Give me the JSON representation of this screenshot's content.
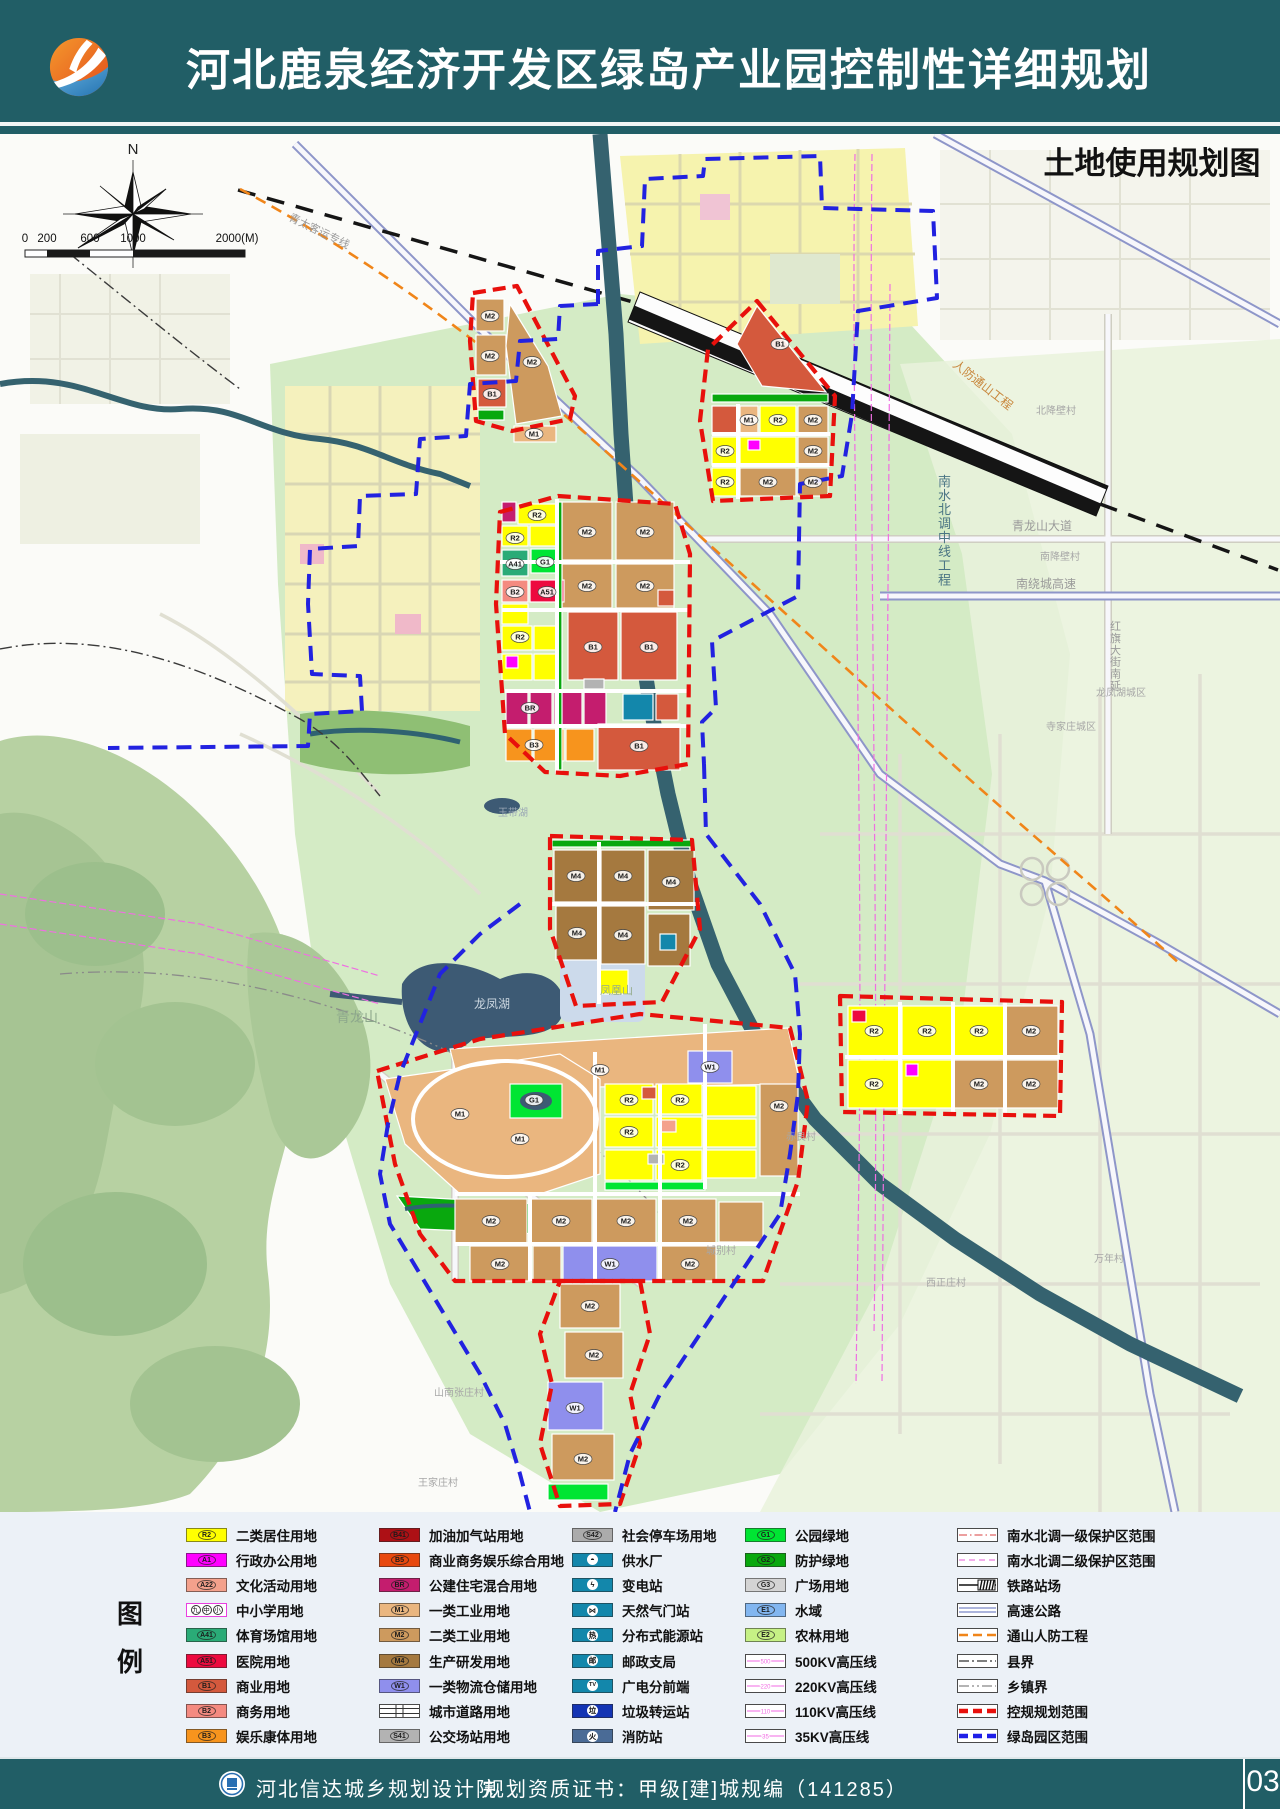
{
  "header": {
    "title": "河北鹿泉经济开发区绿岛产业园控制性详细规划",
    "accent_teal": "#215e66",
    "logo_orange": "#ec6a1e",
    "logo_blue": "#2f86c2"
  },
  "map": {
    "title": "土地使用规划图",
    "compass_label": "N",
    "scale": {
      "labels": [
        "0",
        "200",
        "600",
        "1000",
        "2000(M)"
      ]
    },
    "boundary_colors": {
      "regulatory": "#E8100C",
      "green_island": "#2222E0"
    },
    "place_labels": [
      {
        "text": "南水北调中线工程",
        "x": 938,
        "y": 352,
        "size": 13,
        "color": "#4b7584",
        "vertical": true
      },
      {
        "text": "人防通山工程",
        "x": 952,
        "y": 232,
        "size": 12,
        "color": "#c8863a",
        "rotate": 38
      },
      {
        "text": "青太客运专线",
        "x": 288,
        "y": 86,
        "size": 11,
        "color": "#9a9a9a",
        "rotate": 26
      },
      {
        "text": "青龙山大道",
        "x": 1012,
        "y": 396,
        "size": 12,
        "color": "#9a9a9a"
      },
      {
        "text": "南绕城高速",
        "x": 1016,
        "y": 454,
        "size": 12,
        "color": "#9a9a9a"
      },
      {
        "text": "红旗大街南延",
        "x": 1110,
        "y": 496,
        "size": 11,
        "color": "#9a9a9a",
        "vertical": true
      },
      {
        "text": "青龙山",
        "x": 336,
        "y": 888,
        "size": 14,
        "color": "#8da88c"
      },
      {
        "text": "龙凤湖",
        "x": 474,
        "y": 874,
        "size": 12,
        "color": "#cdd8e2"
      },
      {
        "text": "凤凰山",
        "x": 600,
        "y": 860,
        "size": 11,
        "color": "#94ab8a"
      },
      {
        "text": "玉带湖",
        "x": 498,
        "y": 682,
        "size": 10,
        "color": "#9aa7b5"
      },
      {
        "text": "北降壁村",
        "x": 1036,
        "y": 280,
        "size": 10,
        "color": "#a7a7a7"
      },
      {
        "text": "南降壁村",
        "x": 1040,
        "y": 426,
        "size": 10,
        "color": "#a7a7a7"
      },
      {
        "text": "龙凤湖城区",
        "x": 1096,
        "y": 562,
        "size": 10,
        "color": "#a7a7a7"
      },
      {
        "text": "寺家庄城区",
        "x": 1046,
        "y": 596,
        "size": 10,
        "color": "#a7a7a7"
      },
      {
        "text": "赤良村",
        "x": 786,
        "y": 1006,
        "size": 10,
        "color": "#a7a7a7"
      },
      {
        "text": "万年村",
        "x": 1094,
        "y": 1128,
        "size": 10,
        "color": "#a7a7a7"
      },
      {
        "text": "西正庄村",
        "x": 926,
        "y": 1152,
        "size": 10,
        "color": "#a7a7a7"
      },
      {
        "text": "城别村",
        "x": 706,
        "y": 1120,
        "size": 10,
        "color": "#a7a7a7"
      },
      {
        "text": "山南张庄村",
        "x": 434,
        "y": 1262,
        "size": 10,
        "color": "#a7a7a7"
      },
      {
        "text": "王家庄村",
        "x": 418,
        "y": 1352,
        "size": 10,
        "color": "#a7a7a7"
      }
    ],
    "parcel_codes": [
      {
        "code": "M2",
        "x": 490,
        "y": 182
      },
      {
        "code": "M2",
        "x": 490,
        "y": 222
      },
      {
        "code": "B1",
        "x": 492,
        "y": 260
      },
      {
        "code": "M2",
        "x": 532,
        "y": 228
      },
      {
        "code": "M1",
        "x": 534,
        "y": 300
      },
      {
        "code": "B1",
        "x": 780,
        "y": 210
      },
      {
        "code": "M1",
        "x": 749,
        "y": 286
      },
      {
        "code": "R2",
        "x": 778,
        "y": 286
      },
      {
        "code": "M2",
        "x": 813,
        "y": 286
      },
      {
        "code": "R2",
        "x": 725,
        "y": 317
      },
      {
        "code": "M2",
        "x": 813,
        "y": 317
      },
      {
        "code": "M2",
        "x": 768,
        "y": 348
      },
      {
        "code": "M2",
        "x": 813,
        "y": 348
      },
      {
        "code": "R2",
        "x": 725,
        "y": 348
      },
      {
        "code": "M2",
        "x": 587,
        "y": 398
      },
      {
        "code": "M2",
        "x": 645,
        "y": 398
      },
      {
        "code": "M2",
        "x": 587,
        "y": 452
      },
      {
        "code": "M2",
        "x": 645,
        "y": 452
      },
      {
        "code": "R2",
        "x": 537,
        "y": 381
      },
      {
        "code": "R2",
        "x": 515,
        "y": 404
      },
      {
        "code": "A41",
        "x": 515,
        "y": 430
      },
      {
        "code": "G1",
        "x": 545,
        "y": 428
      },
      {
        "code": "B2",
        "x": 515,
        "y": 458
      },
      {
        "code": "A51",
        "x": 547,
        "y": 458
      },
      {
        "code": "B1",
        "x": 593,
        "y": 513
      },
      {
        "code": "B1",
        "x": 649,
        "y": 513
      },
      {
        "code": "R2",
        "x": 520,
        "y": 503
      },
      {
        "code": "BR",
        "x": 530,
        "y": 574
      },
      {
        "code": "B3",
        "x": 534,
        "y": 611
      },
      {
        "code": "B1",
        "x": 639,
        "y": 612
      },
      {
        "code": "M4",
        "x": 576,
        "y": 742
      },
      {
        "code": "M4",
        "x": 623,
        "y": 742
      },
      {
        "code": "M4",
        "x": 671,
        "y": 748
      },
      {
        "code": "M4",
        "x": 577,
        "y": 799
      },
      {
        "code": "M4",
        "x": 623,
        "y": 801
      },
      {
        "code": "M1",
        "x": 600,
        "y": 936
      },
      {
        "code": "M1",
        "x": 460,
        "y": 980
      },
      {
        "code": "M1",
        "x": 520,
        "y": 1005
      },
      {
        "code": "G1",
        "x": 534,
        "y": 966
      },
      {
        "code": "R2",
        "x": 629,
        "y": 966
      },
      {
        "code": "R2",
        "x": 680,
        "y": 966
      },
      {
        "code": "R2",
        "x": 629,
        "y": 998
      },
      {
        "code": "R2",
        "x": 680,
        "y": 1031
      },
      {
        "code": "W1",
        "x": 710,
        "y": 933
      },
      {
        "code": "M2",
        "x": 779,
        "y": 972
      },
      {
        "code": "M2",
        "x": 491,
        "y": 1087
      },
      {
        "code": "M2",
        "x": 561,
        "y": 1087
      },
      {
        "code": "M2",
        "x": 626,
        "y": 1087
      },
      {
        "code": "M2",
        "x": 688,
        "y": 1087
      },
      {
        "code": "M2",
        "x": 500,
        "y": 1130
      },
      {
        "code": "W1",
        "x": 610,
        "y": 1130
      },
      {
        "code": "M2",
        "x": 690,
        "y": 1130
      },
      {
        "code": "R2",
        "x": 874,
        "y": 897
      },
      {
        "code": "R2",
        "x": 927,
        "y": 897
      },
      {
        "code": "R2",
        "x": 979,
        "y": 897
      },
      {
        "code": "M2",
        "x": 1031,
        "y": 897
      },
      {
        "code": "R2",
        "x": 874,
        "y": 950
      },
      {
        "code": "M2",
        "x": 979,
        "y": 950
      },
      {
        "code": "M2",
        "x": 1031,
        "y": 950
      },
      {
        "code": "M2",
        "x": 590,
        "y": 1172
      },
      {
        "code": "M2",
        "x": 594,
        "y": 1221
      },
      {
        "code": "W1",
        "x": 575,
        "y": 1274
      },
      {
        "code": "M2",
        "x": 583,
        "y": 1325
      }
    ]
  },
  "legend": {
    "panel_title": [
      "图",
      "例"
    ],
    "columns": [
      {
        "items": [
          {
            "label": "二类居住用地",
            "swatch": {
              "kind": "fill",
              "color": "#FFFF00",
              "code": "R2"
            }
          },
          {
            "label": "行政办公用地",
            "swatch": {
              "kind": "fill",
              "color": "#FF00FF",
              "code": "A1"
            }
          },
          {
            "label": "文化活动用地",
            "swatch": {
              "kind": "fill",
              "color": "#F4A18C",
              "code": "A22"
            }
          },
          {
            "label": "中小学用地",
            "swatch": {
              "kind": "school",
              "chars": [
                "九",
                "中",
                "小"
              ]
            }
          },
          {
            "label": "体育场馆用地",
            "swatch": {
              "kind": "fill",
              "color": "#2AAB77",
              "code": "A41"
            }
          },
          {
            "label": "医院用地",
            "swatch": {
              "kind": "fill",
              "color": "#ED0A3F",
              "code": "A51"
            }
          },
          {
            "label": "商业用地",
            "swatch": {
              "kind": "fill",
              "color": "#D4593D",
              "code": "B1"
            }
          },
          {
            "label": "商务用地",
            "swatch": {
              "kind": "fill",
              "color": "#F48A80",
              "code": "B2"
            }
          },
          {
            "label": "娱乐康体用地",
            "swatch": {
              "kind": "fill",
              "color": "#F7941D",
              "code": "B3"
            }
          }
        ]
      },
      {
        "items": [
          {
            "label": "加油加气站用地",
            "swatch": {
              "kind": "fill",
              "color": "#AD1015",
              "code": "B41"
            }
          },
          {
            "label": "商业商务娱乐综合用地",
            "swatch": {
              "kind": "fill",
              "color": "#E8490F",
              "code": "B5"
            }
          },
          {
            "label": "公建住宅混合用地",
            "swatch": {
              "kind": "fill",
              "color": "#C41D6E",
              "code": "BR"
            }
          },
          {
            "label": "一类工业用地",
            "swatch": {
              "kind": "fill",
              "color": "#EAB67F",
              "code": "M1"
            }
          },
          {
            "label": "二类工业用地",
            "swatch": {
              "kind": "fill",
              "color": "#CD9A5E",
              "code": "M2"
            }
          },
          {
            "label": "生产研发用地",
            "swatch": {
              "kind": "fill",
              "color": "#A5793F",
              "code": "M4"
            }
          },
          {
            "label": "一类物流仓储用地",
            "swatch": {
              "kind": "fill",
              "color": "#8F8FED",
              "code": "W1"
            }
          },
          {
            "label": "城市道路用地",
            "swatch": {
              "kind": "roadx"
            }
          },
          {
            "label": "公交场站用地",
            "swatch": {
              "kind": "fill",
              "color": "#B3B3B3",
              "code": "S41"
            }
          }
        ]
      },
      {
        "items": [
          {
            "label": "社会停车场用地",
            "swatch": {
              "kind": "fill",
              "color": "#ABABAB",
              "code": "S42"
            }
          },
          {
            "label": "供水厂",
            "swatch": {
              "kind": "icon",
              "bg": "#1387AB",
              "glyph": "◓"
            }
          },
          {
            "label": "变电站",
            "swatch": {
              "kind": "icon",
              "bg": "#1387AB",
              "glyph": "ϟ"
            }
          },
          {
            "label": "天然气门站",
            "swatch": {
              "kind": "icon",
              "bg": "#1387AB",
              "glyph": "⋈"
            }
          },
          {
            "label": "分布式能源站",
            "swatch": {
              "kind": "icon",
              "bg": "#1387AB",
              "glyph": "热"
            }
          },
          {
            "label": "邮政支局",
            "swatch": {
              "kind": "icon",
              "bg": "#1387AB",
              "glyph": "邮"
            }
          },
          {
            "label": "广电分前端",
            "swatch": {
              "kind": "icon",
              "bg": "#1387AB",
              "glyph": "TV"
            }
          },
          {
            "label": "垃圾转运站",
            "swatch": {
              "kind": "icon",
              "bg": "#1434B4",
              "glyph": "垃"
            }
          },
          {
            "label": "消防站",
            "swatch": {
              "kind": "icon",
              "bg": "#4A6B96",
              "glyph": "火"
            }
          }
        ]
      },
      {
        "items": [
          {
            "label": "公园绿地",
            "swatch": {
              "kind": "fill",
              "color": "#00E533",
              "code": "G1"
            }
          },
          {
            "label": "防护绿地",
            "swatch": {
              "kind": "fill",
              "color": "#09A80E",
              "code": "G2"
            }
          },
          {
            "label": "广场用地",
            "swatch": {
              "kind": "fill",
              "color": "#D4D4D4",
              "code": "G3"
            }
          },
          {
            "label": "水域",
            "swatch": {
              "kind": "fill",
              "color": "#82B6F0",
              "code": "E1"
            }
          },
          {
            "label": "农林用地",
            "swatch": {
              "kind": "fill",
              "color": "#C6F185",
              "code": "E2"
            }
          },
          {
            "label": "500KV高压线",
            "swatch": {
              "kind": "kvline",
              "num": "500",
              "color": "#F26AE3"
            }
          },
          {
            "label": "220KV高压线",
            "swatch": {
              "kind": "kvline",
              "num": "220",
              "color": "#F26AE3"
            }
          },
          {
            "label": "110KV高压线",
            "swatch": {
              "kind": "kvline",
              "num": "110",
              "color": "#F26AE3"
            }
          },
          {
            "label": "35KV高压线",
            "swatch": {
              "kind": "kvline",
              "num": "35",
              "color": "#F26AE3"
            }
          }
        ]
      },
      {
        "items": [
          {
            "label": "南水北调一级保护区范围",
            "swatch": {
              "kind": "line",
              "color": "#E06666",
              "width": 1.2,
              "dash": "8 3 1.5 3"
            }
          },
          {
            "label": "南水北调二级保护区范围",
            "swatch": {
              "kind": "line",
              "color": "#EE7CE0",
              "width": 1.2,
              "dash": "6 4"
            }
          },
          {
            "label": "铁路站场",
            "swatch": {
              "kind": "rail"
            }
          },
          {
            "label": "高速公路",
            "swatch": {
              "kind": "double",
              "color": "#7A86C8"
            }
          },
          {
            "label": "通山人防工程",
            "swatch": {
              "kind": "line",
              "color": "#F08519",
              "width": 2.6,
              "dash": "9 5"
            }
          },
          {
            "label": "县界",
            "swatch": {
              "kind": "line",
              "color": "#333333",
              "width": 1.3,
              "dash": "10 3 2 3"
            }
          },
          {
            "label": "乡镇界",
            "swatch": {
              "kind": "line",
              "color": "#888888",
              "width": 1.3,
              "dash": "10 3 2 3 2 3"
            }
          },
          {
            "label": "控规规划范围",
            "swatch": {
              "kind": "line",
              "color": "#E8100C",
              "width": 4.5,
              "dash": "9 5"
            }
          },
          {
            "label": "绿岛园区范围",
            "swatch": {
              "kind": "line",
              "color": "#1F1FE8",
              "width": 4.5,
              "dash": "9 5"
            }
          }
        ]
      }
    ]
  },
  "footer": {
    "institute": "河北信达城乡规划设计院",
    "certificate": "规划资质证书：甲级[建]城规编（141285）",
    "page_number": "03"
  }
}
